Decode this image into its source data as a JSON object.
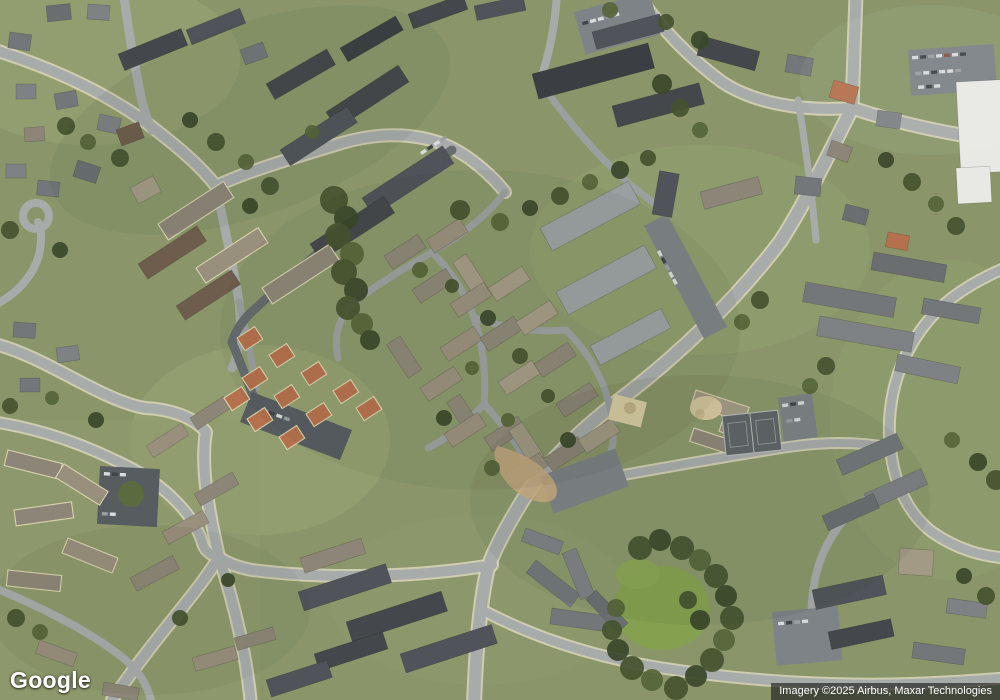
{
  "map": {
    "view_type": "satellite",
    "description": "Aerial imagery of a suburban residential area with townhouse complexes, apartment buildings, winding roads, parking lots, tennis courts and tree cover",
    "palette": {
      "grass": "#8a966a",
      "meadow": "#85a04e",
      "trees_dark": "#3a4729",
      "road": "#a7acab",
      "sidewalk": "#d9d6bb",
      "asphalt_dark": "#666c6f",
      "roof_dark": "#44484c",
      "roof_gray": "#73777a",
      "roof_tan": "#a39a85",
      "roof_terracotta": "#b5714e",
      "roof_white": "#e8e8e4"
    },
    "features": [
      "roads",
      "townhouse-rows",
      "apartment-buildings",
      "detached-houses",
      "parking-lots",
      "tennis-courts",
      "playground",
      "meadow",
      "trees"
    ]
  },
  "overlay": {
    "logo_text": "Google",
    "attribution_text": "Imagery ©2025 Airbus, Maxar Technologies"
  }
}
